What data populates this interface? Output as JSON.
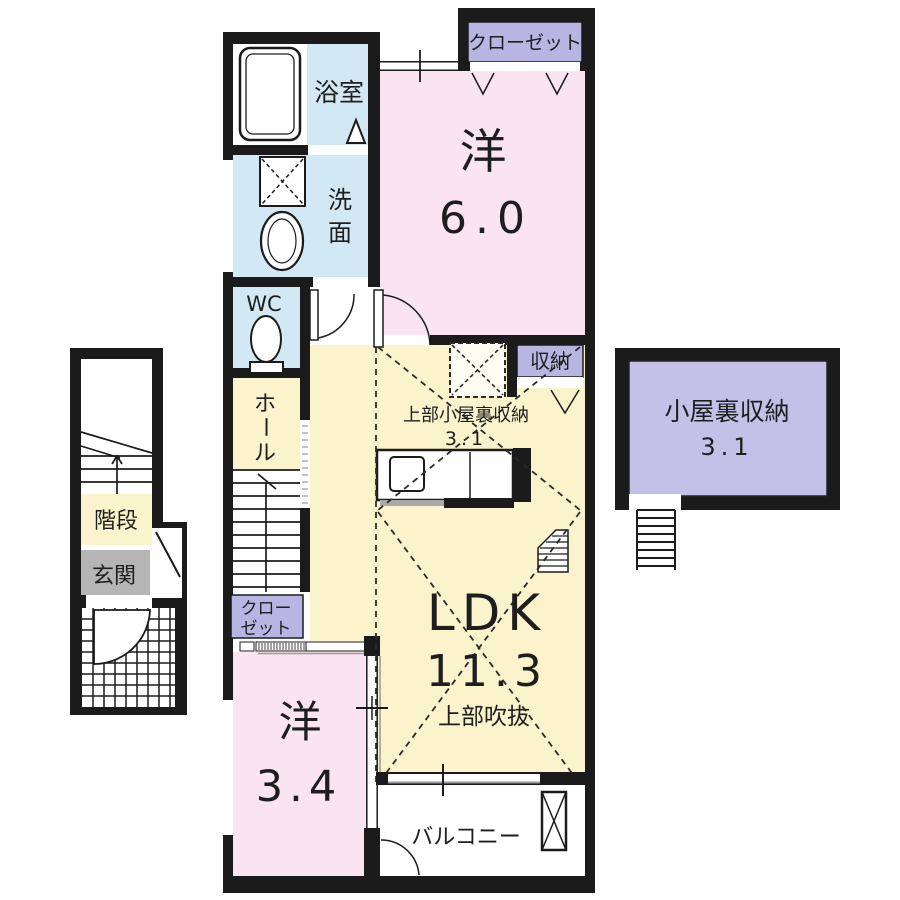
{
  "colors": {
    "wall": "#1b1b1b",
    "room_pink": "#f9e4ef",
    "room_yellow": "#faf3cc",
    "room_blue": "#d2e8f4",
    "attic_purple": "#c4c0e8",
    "label_purple": "#b9b5e2",
    "entrance_gray": "#b5b5b5",
    "background": "#ffffff"
  },
  "plan": {
    "rooms": {
      "bath": {
        "label": "浴室"
      },
      "washroom": {
        "chars": [
          "洗",
          "面"
        ]
      },
      "wc": {
        "label": "WC"
      },
      "hall": {
        "chars": [
          "ホ",
          "ー",
          "ル"
        ]
      },
      "stairs_1f": {
        "label": "階段"
      },
      "entrance": {
        "label": "玄関"
      },
      "closet_top": {
        "label": "クローゼット"
      },
      "closet_2f": {
        "lines": [
          "クロー",
          "ゼット"
        ]
      },
      "bedroom_6": {
        "name": "洋",
        "size": "6.0"
      },
      "storage": {
        "label": "収納"
      },
      "loft_note": {
        "label": "上部小屋裏収納",
        "size": "3.1"
      },
      "ldk": {
        "name": "LDK",
        "size": "11.3",
        "note": "上部吹抜"
      },
      "bedroom_34": {
        "name": "洋",
        "size": "3.4"
      },
      "balcony": {
        "label": "バルコニー"
      },
      "attic": {
        "name": "小屋裏収納",
        "size": "3.1"
      }
    }
  }
}
